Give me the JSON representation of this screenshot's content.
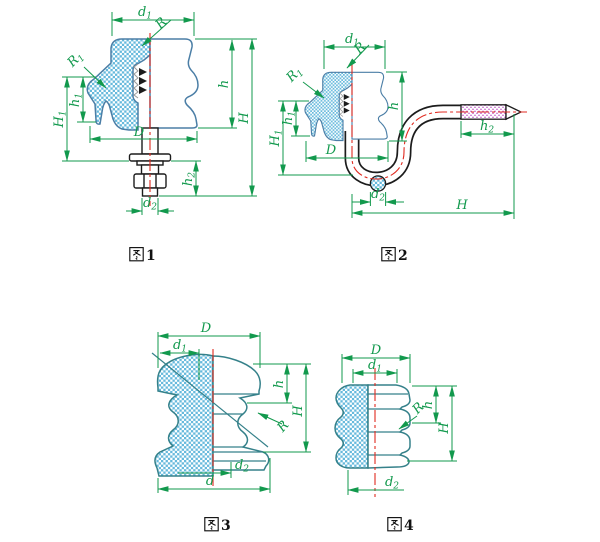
{
  "page": {
    "background": "#ffffff"
  },
  "drawing": {
    "colors": {
      "dimension": "#12994d",
      "centerline": "#e02a20",
      "insulator_profile": "#4b7ea6",
      "spool_profile": "#35818a",
      "hatch": "#66b9dc",
      "hardware_outline": "#1c1c1c",
      "stud_fill": "#e9e493",
      "thread_dots": "#bb4fc4"
    },
    "labels": {
      "d1": {
        "base": "d",
        "sub": "1"
      },
      "d2": {
        "base": "d",
        "sub": "2"
      },
      "D": {
        "base": "D",
        "sub": ""
      },
      "d": {
        "base": "d",
        "sub": ""
      },
      "h": {
        "base": "h",
        "sub": ""
      },
      "H": {
        "base": "H",
        "sub": ""
      },
      "h1": {
        "base": "h",
        "sub": "1"
      },
      "h2": {
        "base": "h",
        "sub": "2"
      },
      "H1": {
        "base": "H",
        "sub": "1"
      },
      "R": {
        "base": "R",
        "sub": ""
      },
      "R1": {
        "base": "R",
        "sub": "1"
      }
    },
    "figures": [
      {
        "caption": "图1",
        "number": "1",
        "dimensions": [
          "d1",
          "R",
          "R1",
          "h1",
          "H1",
          "D",
          "h",
          "H",
          "h2",
          "d2"
        ]
      },
      {
        "caption": "图2",
        "number": "2",
        "dimensions": [
          "d1",
          "R",
          "R1",
          "h1",
          "H1",
          "D",
          "h",
          "H",
          "h2",
          "d2"
        ]
      },
      {
        "caption": "图3",
        "number": "3",
        "dimensions": [
          "D",
          "d1",
          "h",
          "H",
          "R",
          "d2",
          "d"
        ]
      },
      {
        "caption": "图4",
        "number": "4",
        "dimensions": [
          "D",
          "d1",
          "h",
          "H",
          "R",
          "d2"
        ]
      }
    ]
  }
}
